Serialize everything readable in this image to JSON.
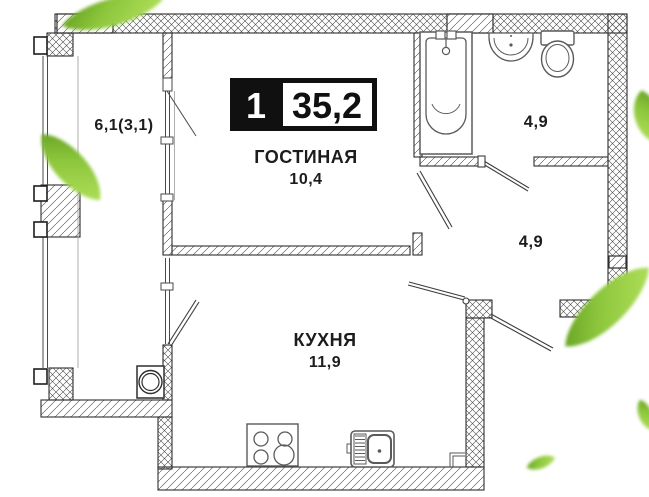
{
  "badge": {
    "rooms_count": "1",
    "total_area": "35,2"
  },
  "rooms": {
    "living": {
      "label": "ГОСТИНАЯ",
      "area": "10,4"
    },
    "kitchen": {
      "label": "КУХНЯ",
      "area": "11,9"
    },
    "balcony": {
      "area": "6,1(3,1)"
    },
    "bathroom": {
      "area": "4,9"
    },
    "hallway": {
      "area": "4,9"
    }
  },
  "colors": {
    "background": "#ffffff",
    "wall_line": "#2e2e2e",
    "fixture_line": "#5a5a5a",
    "text": "#1c1c1c",
    "badge_bg": "#101010",
    "badge_text_on_dark": "#ffffff",
    "leaf_dark": "#639d1c",
    "leaf_mid": "#8cc63c",
    "leaf_light": "#aadb55"
  }
}
